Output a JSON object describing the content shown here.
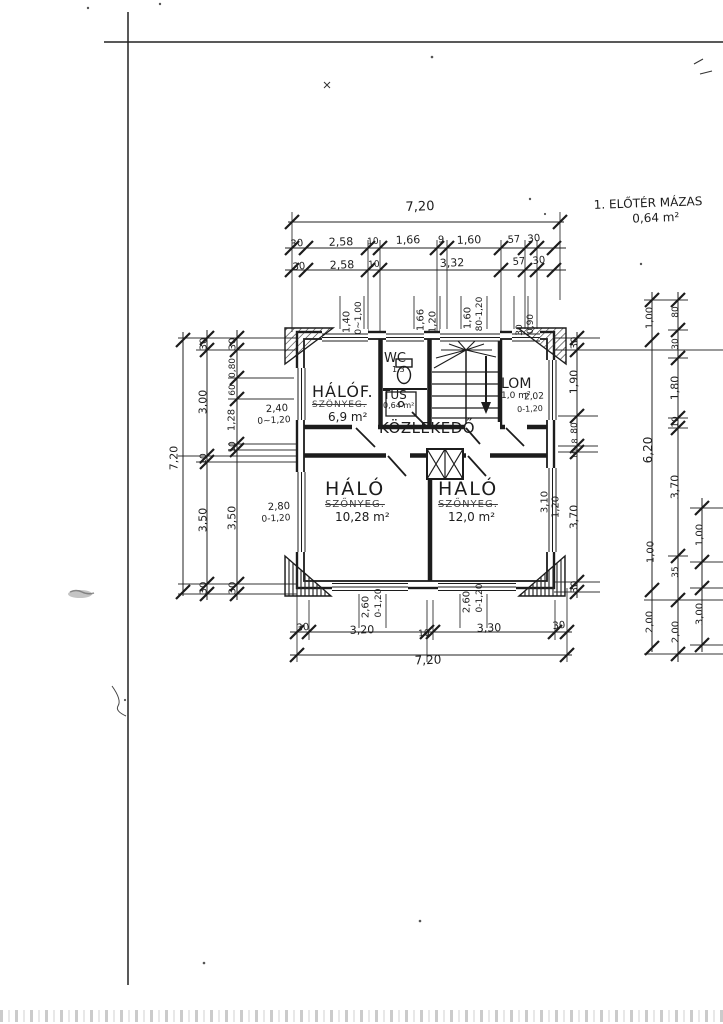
{
  "colors": {
    "ink": "#1c1c1c",
    "paper": "#ffffff"
  },
  "note": {
    "line1": "1. ELŐTÉR MÁZAS",
    "line2": "0,64 m²"
  },
  "rooms": {
    "halof": {
      "name": "HÁLÓF.",
      "finish": "SZŐNYEG.",
      "area": "6,9 m²"
    },
    "wc": {
      "name": "WC",
      "area": "1,3"
    },
    "tus": {
      "name": "TUS",
      "area": "0,64 m²"
    },
    "lom": {
      "name": "LOM",
      "area": "1,0 m²"
    },
    "kozlekedo": {
      "name": "KÖZLEKEDŐ"
    },
    "halo1": {
      "name": "HÁLÓ",
      "finish": "SZŐNYEG.",
      "area": "10,28 m²"
    },
    "halo2": {
      "name": "HÁLÓ",
      "finish": "SZŐNYEG.",
      "area": "12,0 m²"
    }
  },
  "dim_labels": [
    {
      "name": "dim-top-overall",
      "text": "7,20",
      "x": 420,
      "y": 207,
      "rot": -2,
      "fs": 13
    },
    {
      "text": "30",
      "x": 297,
      "y": 244,
      "rot": -6,
      "fs": 10
    },
    {
      "text": "2,58",
      "x": 341,
      "y": 242,
      "rot": -2,
      "fs": 11
    },
    {
      "text": "10",
      "x": 373,
      "y": 242,
      "rot": -4,
      "fs": 9
    },
    {
      "text": "1,66",
      "x": 408,
      "y": 240,
      "rot": -2,
      "fs": 11
    },
    {
      "text": "9",
      "x": 441,
      "y": 240,
      "rot": 0,
      "fs": 10
    },
    {
      "text": "1,60",
      "x": 469,
      "y": 240,
      "rot": -2,
      "fs": 11
    },
    {
      "text": "57",
      "x": 514,
      "y": 240,
      "rot": -4,
      "fs": 10
    },
    {
      "text": "30",
      "x": 534,
      "y": 239,
      "rot": -6,
      "fs": 10
    },
    {
      "text": "30",
      "x": 299,
      "y": 267,
      "rot": -6,
      "fs": 10
    },
    {
      "text": "2,58",
      "x": 342,
      "y": 265,
      "rot": -2,
      "fs": 11
    },
    {
      "text": "10",
      "x": 374,
      "y": 265,
      "rot": -4,
      "fs": 9
    },
    {
      "text": "3,32",
      "x": 452,
      "y": 263,
      "rot": -2,
      "fs": 11
    },
    {
      "text": "57",
      "x": 519,
      "y": 262,
      "rot": -4,
      "fs": 10
    },
    {
      "text": "30",
      "x": 539,
      "y": 261,
      "rot": -6,
      "fs": 10
    },
    {
      "text": "1,40",
      "x": 347,
      "y": 322,
      "rot": -90,
      "fs": 10
    },
    {
      "text": "0~1,00",
      "x": 359,
      "y": 318,
      "rot": -90,
      "fs": 9
    },
    {
      "text": "1,66",
      "x": 421,
      "y": 320,
      "rot": -90,
      "fs": 10
    },
    {
      "text": "1,20",
      "x": 433,
      "y": 322,
      "rot": -90,
      "fs": 10
    },
    {
      "text": "1,60",
      "x": 468,
      "y": 318,
      "rot": -90,
      "fs": 10
    },
    {
      "text": "80-1,20",
      "x": 480,
      "y": 314,
      "rot": -90,
      "fs": 9
    },
    {
      "text": "30",
      "x": 520,
      "y": 330,
      "rot": -90,
      "fs": 9
    },
    {
      "text": "0,90",
      "x": 531,
      "y": 324,
      "rot": -90,
      "fs": 9
    },
    {
      "name": "dim-left-overall",
      "text": "7,20",
      "x": 174,
      "y": 458,
      "rot": -90,
      "fs": 11
    },
    {
      "text": "30",
      "x": 204,
      "y": 344,
      "rot": -90,
      "fs": 10
    },
    {
      "text": "3,00",
      "x": 203,
      "y": 402,
      "rot": -90,
      "fs": 11
    },
    {
      "text": "10",
      "x": 204,
      "y": 459,
      "rot": -90,
      "fs": 9
    },
    {
      "text": "3,50",
      "x": 203,
      "y": 520,
      "rot": -90,
      "fs": 11
    },
    {
      "text": "30",
      "x": 204,
      "y": 588,
      "rot": -90,
      "fs": 10
    },
    {
      "text": "30",
      "x": 233,
      "y": 344,
      "rot": -90,
      "fs": 10
    },
    {
      "text": "0,80",
      "x": 233,
      "y": 368,
      "rot": -90,
      "fs": 9
    },
    {
      "text": "60",
      "x": 233,
      "y": 390,
      "rot": -90,
      "fs": 9
    },
    {
      "text": "1,28",
      "x": 232,
      "y": 420,
      "rot": -90,
      "fs": 10
    },
    {
      "text": "10",
      "x": 233,
      "y": 447,
      "rot": -90,
      "fs": 9
    },
    {
      "text": "3,50",
      "x": 232,
      "y": 518,
      "rot": -90,
      "fs": 11
    },
    {
      "text": "30",
      "x": 233,
      "y": 588,
      "rot": -90,
      "fs": 10
    },
    {
      "text": "2,40",
      "x": 277,
      "y": 409,
      "rot": -3,
      "fs": 10
    },
    {
      "text": "0~1,20",
      "x": 274,
      "y": 421,
      "rot": -3,
      "fs": 9
    },
    {
      "text": "2,80",
      "x": 279,
      "y": 507,
      "rot": -3,
      "fs": 10
    },
    {
      "text": "0-1,20",
      "x": 276,
      "y": 519,
      "rot": -3,
      "fs": 9
    },
    {
      "text": "30",
      "x": 575,
      "y": 343,
      "rot": -90,
      "fs": 10
    },
    {
      "text": "1,90",
      "x": 574,
      "y": 382,
      "rot": -90,
      "fs": 11
    },
    {
      "text": "80",
      "x": 575,
      "y": 428,
      "rot": -90,
      "fs": 9
    },
    {
      "text": "8",
      "x": 575,
      "y": 441,
      "rot": -90,
      "fs": 8
    },
    {
      "text": "10",
      "x": 575,
      "y": 454,
      "rot": -90,
      "fs": 8
    },
    {
      "text": "3,70",
      "x": 574,
      "y": 517,
      "rot": -90,
      "fs": 11
    },
    {
      "text": "30",
      "x": 575,
      "y": 587,
      "rot": -90,
      "fs": 10
    },
    {
      "text": "2,02",
      "x": 534,
      "y": 397,
      "rot": -3,
      "fs": 9
    },
    {
      "text": "0-1,20",
      "x": 530,
      "y": 409,
      "rot": -3,
      "fs": 8
    },
    {
      "text": "3,10",
      "x": 545,
      "y": 502,
      "rot": -90,
      "fs": 10
    },
    {
      "text": "1,20",
      "x": 556,
      "y": 507,
      "rot": -90,
      "fs": 10
    },
    {
      "text": "1,00",
      "x": 650,
      "y": 318,
      "rot": -90,
      "fs": 10
    },
    {
      "text": "6,20",
      "x": 648,
      "y": 450,
      "rot": -90,
      "fs": 12
    },
    {
      "text": "1,00",
      "x": 651,
      "y": 552,
      "rot": -90,
      "fs": 10
    },
    {
      "text": "2,00",
      "x": 650,
      "y": 622,
      "rot": -90,
      "fs": 10
    },
    {
      "text": "80",
      "x": 676,
      "y": 312,
      "rot": -90,
      "fs": 9
    },
    {
      "text": "30",
      "x": 676,
      "y": 344,
      "rot": -90,
      "fs": 9
    },
    {
      "text": "1,80",
      "x": 675,
      "y": 388,
      "rot": -90,
      "fs": 11
    },
    {
      "text": "10",
      "x": 676,
      "y": 422,
      "rot": -90,
      "fs": 9
    },
    {
      "text": "3,70",
      "x": 675,
      "y": 487,
      "rot": -90,
      "fs": 11
    },
    {
      "text": "35",
      "x": 676,
      "y": 572,
      "rot": -90,
      "fs": 9
    },
    {
      "text": "2,00",
      "x": 676,
      "y": 632,
      "rot": -90,
      "fs": 10
    },
    {
      "text": "1,00",
      "x": 700,
      "y": 535,
      "rot": -90,
      "fs": 10
    },
    {
      "text": "3,00",
      "x": 700,
      "y": 614,
      "rot": -90,
      "fs": 10
    },
    {
      "text": "2,60",
      "x": 366,
      "y": 607,
      "rot": -90,
      "fs": 10
    },
    {
      "text": "0-1,20",
      "x": 379,
      "y": 603,
      "rot": -90,
      "fs": 9
    },
    {
      "text": "2,60",
      "x": 467,
      "y": 602,
      "rot": -90,
      "fs": 10
    },
    {
      "text": "0-1,20",
      "x": 480,
      "y": 598,
      "rot": -90,
      "fs": 9
    },
    {
      "text": "30",
      "x": 303,
      "y": 628,
      "rot": -6,
      "fs": 10
    },
    {
      "text": "3,20",
      "x": 362,
      "y": 630,
      "rot": -2,
      "fs": 11
    },
    {
      "text": "10",
      "x": 424,
      "y": 634,
      "rot": -4,
      "fs": 9
    },
    {
      "text": "3,30",
      "x": 489,
      "y": 628,
      "rot": -2,
      "fs": 11
    },
    {
      "text": "30",
      "x": 559,
      "y": 626,
      "rot": -6,
      "fs": 10
    },
    {
      "name": "dim-bottom-overall",
      "text": "7,20",
      "x": 428,
      "y": 660,
      "rot": -2,
      "fs": 12
    }
  ]
}
